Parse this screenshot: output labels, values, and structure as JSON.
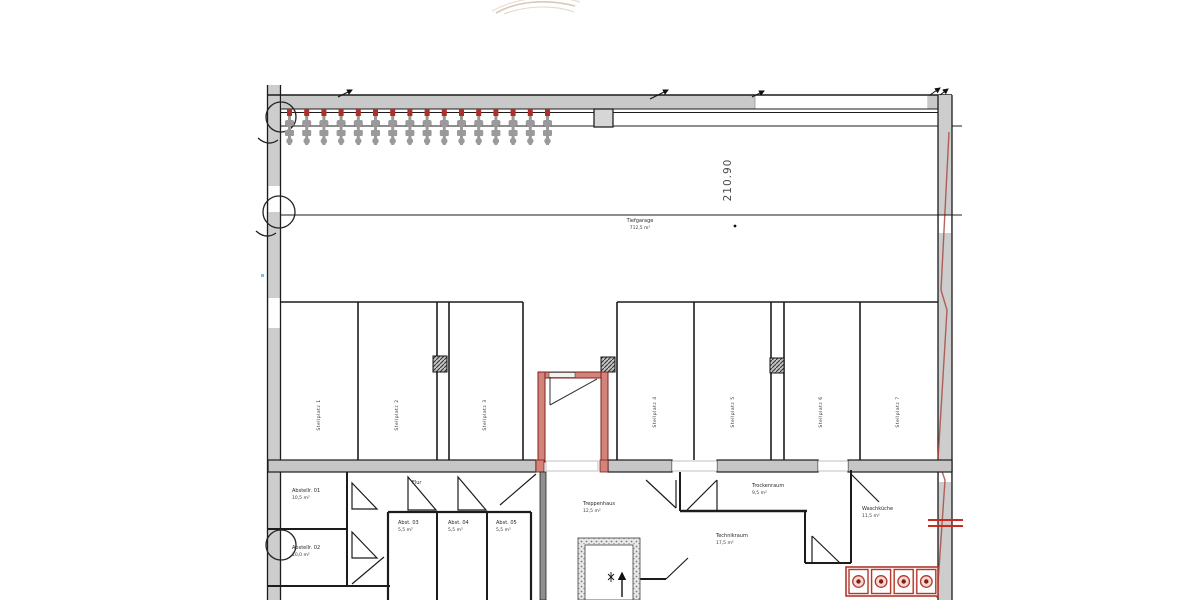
{
  "colors": {
    "wall_gray": "#c9c9c9",
    "line": "#1c1c1c",
    "red": "#b03a2e",
    "red_wall_fill": "#d4837b",
    "red_wall_edge": "#7b241c",
    "dim_text": "#4a4a4a"
  },
  "dimension": {
    "value": "210.90"
  },
  "garage": {
    "name": "Tiefgarage",
    "area": "712,5 m²"
  },
  "stalls": [
    {
      "label": "Stellplatz 1"
    },
    {
      "label": "Stellplatz 2"
    },
    {
      "label": "Stellplatz 3"
    },
    {
      "label": "Stellplatz 4"
    },
    {
      "label": "Stellplatz 5"
    },
    {
      "label": "Stellplatz 6"
    },
    {
      "label": "Stellplatz 7"
    }
  ],
  "rooms": {
    "abstell1": {
      "name": "Abstellr. 01",
      "area": "10,5 m²"
    },
    "abstell2": {
      "name": "Abstellr. 02",
      "area": "10,0 m²"
    },
    "flur": {
      "name": "Flur",
      "area": ""
    },
    "abst3": {
      "name": "Abst. 03",
      "area": "5,5 m²"
    },
    "abst4": {
      "name": "Abst. 04",
      "area": "5,5 m²"
    },
    "abst5": {
      "name": "Abst. 05",
      "area": "5,5 m²"
    },
    "treppe": {
      "name": "Treppenhaus",
      "area": "12,5 m²"
    },
    "trocken": {
      "name": "Trockenraum",
      "area": "9,5 m²"
    },
    "technik": {
      "name": "Technikraum",
      "area": "17,5 m²"
    },
    "wasch": {
      "name": "Waschküche",
      "area": "11,5 m²"
    }
  },
  "equipment": {
    "washer_count": 4,
    "bike_stand_count": 16
  }
}
